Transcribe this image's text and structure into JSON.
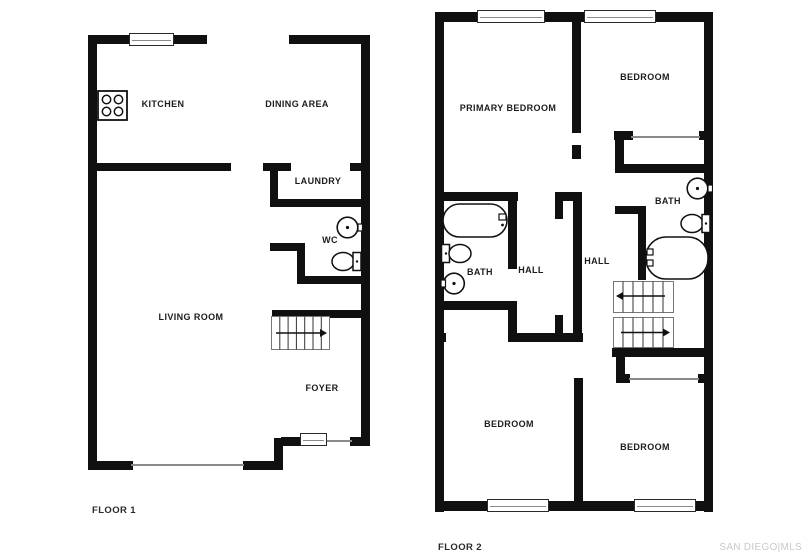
{
  "watermark": "SAN DIEGO|MLS",
  "floor1": {
    "label": "FLOOR 1",
    "rooms": {
      "kitchen": "KITCHEN",
      "dining_area": "DINING AREA",
      "laundry": "LAUNDRY",
      "wc": "WC",
      "living_room": "LIVING ROOM",
      "foyer": "FOYER"
    },
    "icons": [
      "stove-icon",
      "sink-icon",
      "toilet-icon",
      "staircase",
      "window",
      "entry-door"
    ]
  },
  "floor2": {
    "label": "FLOOR 2",
    "rooms": {
      "primary_bedroom": "PRIMARY BEDROOM",
      "bedroom_top_right": "BEDROOM",
      "bath_left": "BATH",
      "hall_left": "HALL",
      "hall_right": "HALL",
      "bath_right": "BATH",
      "bedroom_bottom_left": "BEDROOM",
      "bedroom_bottom_right": "BEDROOM"
    },
    "icons": [
      "bathtub-icon",
      "toilet-icon",
      "sink-icon",
      "staircase",
      "window"
    ]
  },
  "colors": {
    "wall": "#101010",
    "thin_line": "#8a8a8a",
    "label": "#1c1c1c",
    "watermark": "#c9c9c9"
  }
}
